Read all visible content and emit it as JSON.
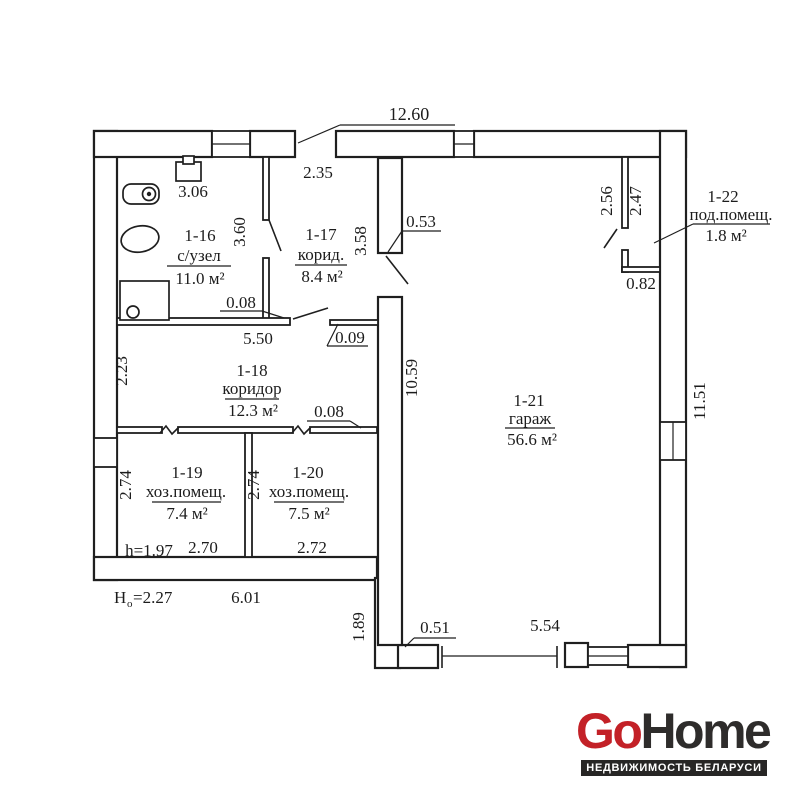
{
  "plan": {
    "rooms": [
      {
        "id": "1-16",
        "name": "с/узел",
        "area": "11.0 м²"
      },
      {
        "id": "1-17",
        "name": "корид.",
        "area": "8.4 м²"
      },
      {
        "id": "1-18",
        "name": "коридор",
        "area": "12.3 м²"
      },
      {
        "id": "1-19",
        "name": "хоз.помещ.",
        "area": "7.4 м²"
      },
      {
        "id": "1-20",
        "name": "хоз.помещ.",
        "area": "7.5 м²"
      },
      {
        "id": "1-21",
        "name": "гараж",
        "area": "56.6 м²"
      },
      {
        "id": "1-22",
        "name": "под.помещ.",
        "area": "1.8 м²"
      }
    ],
    "dims": {
      "overall_width": "12.60",
      "entry_opening": "2.35",
      "basin": "3.06",
      "bath_partition": "3.60",
      "nook": "3.58",
      "stub": "0.53",
      "shaft_left": "2.56",
      "shaft_right": "2.47",
      "shaft_width": "0.82",
      "right_wall": "11.51",
      "garage_left_wall": "10.59",
      "bath_wall_thk": "0.08",
      "bath_wall_len": "5.50",
      "corr_wall_thk": "0.09",
      "corr_left": "2.23",
      "lower_wall_thk": "0.08",
      "room19_h": "2.74",
      "room20_h": "2.74",
      "ceiling_h": "h=1.97",
      "room19_w": "2.70",
      "room20_w": "2.72",
      "outer_h_main": "Н",
      "outer_h_sub": "о",
      "outer_h_val": "=2.27",
      "bottom_len": "6.01",
      "ledge": "1.89",
      "door_stub": "0.51",
      "garage_door": "5.54"
    }
  },
  "logo": {
    "go": "Go",
    "home": "Home",
    "tagline": "НЕДВИЖИМОСТЬ БЕЛАРУСИ",
    "red": "#c32127",
    "dark": "#2e2c2b",
    "bar_bg": "#272625"
  },
  "colors": {
    "line": "#1f1f1f",
    "background": "#ffffff"
  }
}
